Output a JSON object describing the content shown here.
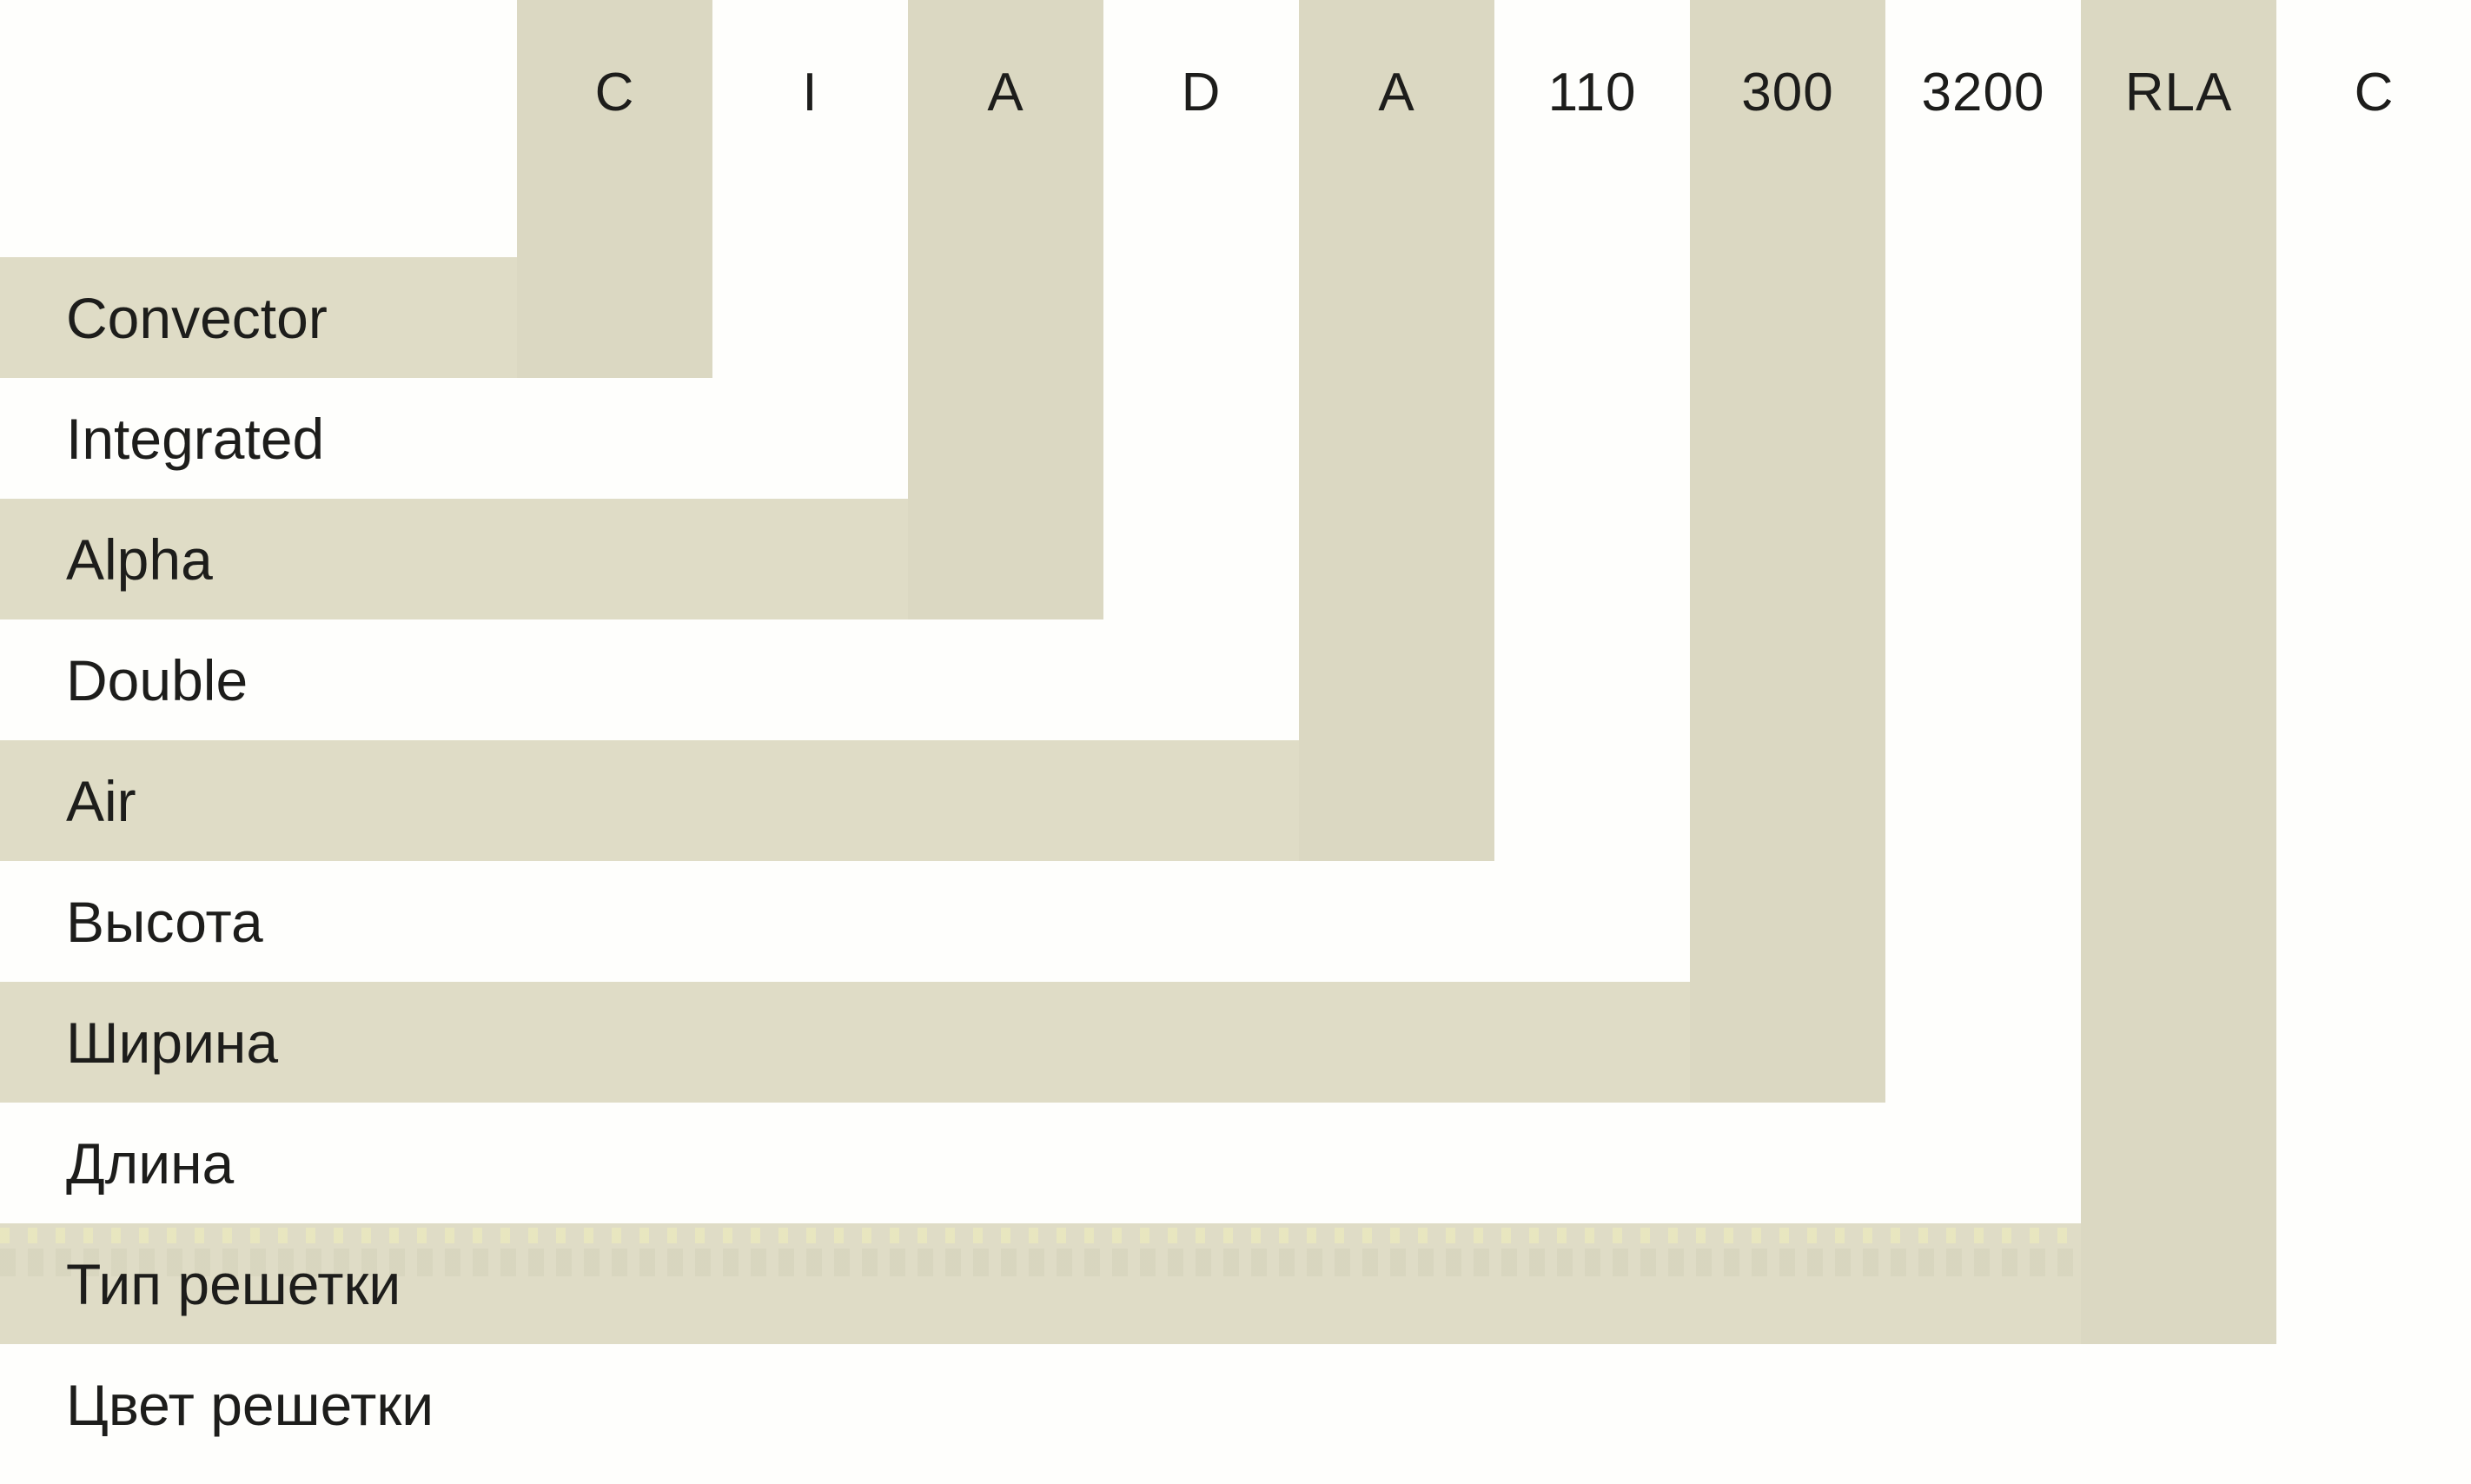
{
  "diagram": {
    "description_role": "model-code nomenclature decoder",
    "segments": [
      {
        "code": "C",
        "label": "Convector",
        "shaded": true
      },
      {
        "code": "I",
        "label": "Integrated",
        "shaded": false
      },
      {
        "code": "A",
        "label": "Alpha",
        "shaded": true
      },
      {
        "code": "D",
        "label": "Double",
        "shaded": false
      },
      {
        "code": "A",
        "label": "Air",
        "shaded": true
      },
      {
        "code": "110",
        "label": "Высота",
        "shaded": false
      },
      {
        "code": "300",
        "label": "Ширина",
        "shaded": true
      },
      {
        "code": "3200",
        "label": "Длина",
        "shaded": false
      },
      {
        "code": "RLA",
        "label": "Тип решетки",
        "shaded": true
      },
      {
        "code": "C",
        "label": "Цвет решетки",
        "shaded": false
      }
    ],
    "colors": {
      "background": "#fefefc",
      "column_band": "#dbd8c2",
      "row_band": "#dfdcc6",
      "text": "#1d1d1b",
      "dotted_light": "#e8e6bf",
      "dotted_dark": "#cfccb4"
    }
  }
}
